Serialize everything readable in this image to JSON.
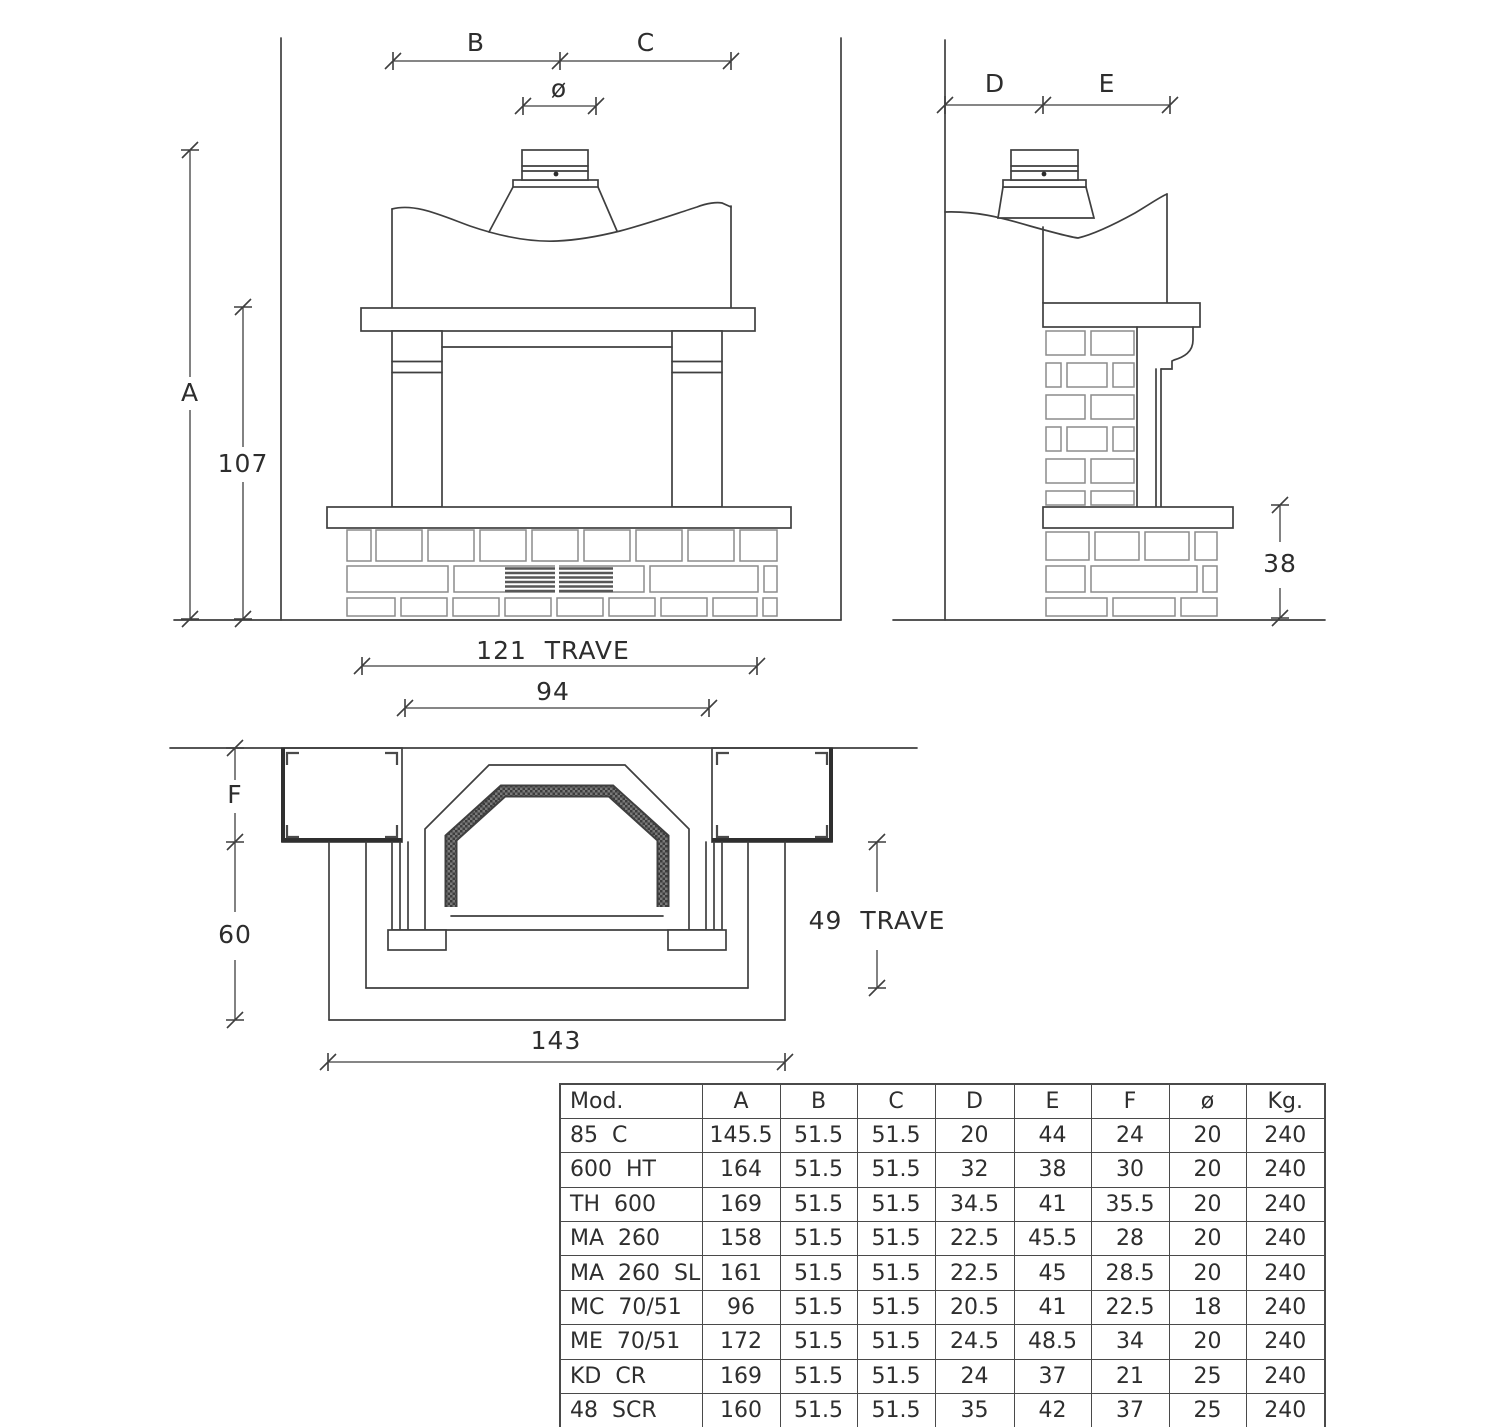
{
  "colors": {
    "ink": "#3f3f3f",
    "background": "#ffffff"
  },
  "front_view": {
    "labels": {
      "b": "B",
      "c": "C",
      "diameter": "ø",
      "a": "A",
      "h107": "107",
      "trave": "121  TRAVE",
      "w94": "94"
    }
  },
  "side_view": {
    "labels": {
      "d": "D",
      "e": "E",
      "h38": "38"
    }
  },
  "plan_view": {
    "labels": {
      "f": "F",
      "h60": "60",
      "trave": "49  TRAVE",
      "w143": "143"
    }
  },
  "table": {
    "headers": [
      "Mod.",
      "A",
      "B",
      "C",
      "D",
      "E",
      "F",
      "ø",
      "Kg."
    ],
    "rows": [
      [
        "85 C",
        "145.5",
        "51.5",
        "51.5",
        "20",
        "44",
        "24",
        "20",
        "240"
      ],
      [
        "600 HT",
        "164",
        "51.5",
        "51.5",
        "32",
        "38",
        "30",
        "20",
        "240"
      ],
      [
        "TH 600",
        "169",
        "51.5",
        "51.5",
        "34.5",
        "41",
        "35.5",
        "20",
        "240"
      ],
      [
        "MA 260",
        "158",
        "51.5",
        "51.5",
        "22.5",
        "45.5",
        "28",
        "20",
        "240"
      ],
      [
        "MA 260 SL",
        "161",
        "51.5",
        "51.5",
        "22.5",
        "45",
        "28.5",
        "20",
        "240"
      ],
      [
        "MC 70/51",
        "96",
        "51.5",
        "51.5",
        "20.5",
        "41",
        "22.5",
        "18",
        "240"
      ],
      [
        "ME 70/51",
        "172",
        "51.5",
        "51.5",
        "24.5",
        "48.5",
        "34",
        "20",
        "240"
      ],
      [
        "KD CR",
        "169",
        "51.5",
        "51.5",
        "24",
        "37",
        "21",
        "25",
        "240"
      ],
      [
        "48 SCR",
        "160",
        "51.5",
        "51.5",
        "35",
        "42",
        "37",
        "25",
        "240"
      ]
    ]
  }
}
